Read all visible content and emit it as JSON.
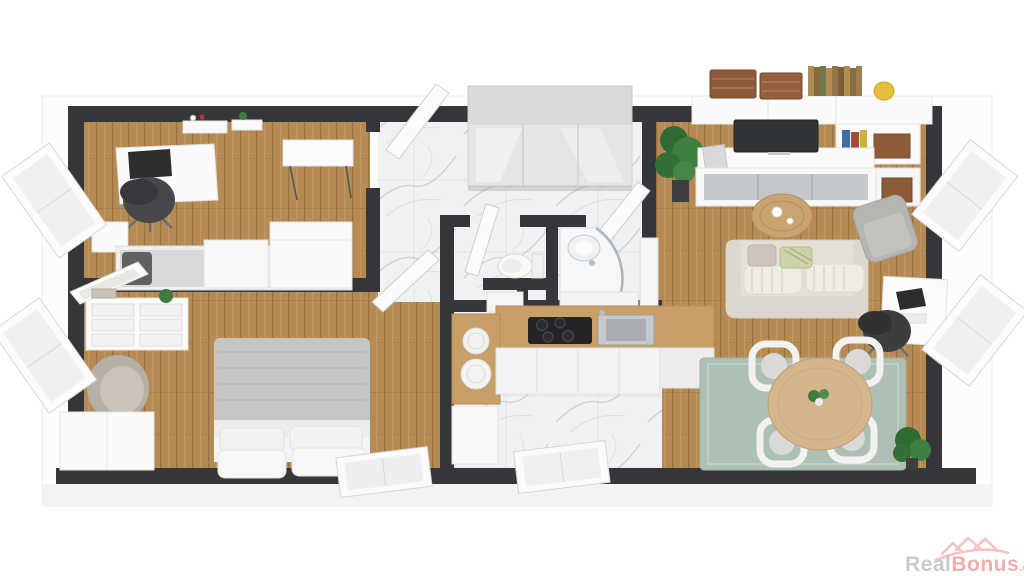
{
  "watermark": {
    "text_real": "Real",
    "text_bonus": "Bonus",
    "text_tld": ".cz",
    "color_real": "#c9c9c9",
    "color_bonus": "#f0aeae",
    "logo": "houses-roofline-swoosh"
  },
  "palette": {
    "background": "#ffffff",
    "outer_slab": "#fcfcfd",
    "wall_dark": "#34363a",
    "wall_white": "#f6f6f6",
    "wood_floor": "#b58b53",
    "wood_counter": "#c89f67",
    "marble_floor": "#f0f1f2",
    "rug_sage": "#aebfb6",
    "sofa_beige": "#e4e0d9",
    "armchair_gray": "#b7b5b2",
    "office_chair_dark": "#3b3d3f",
    "tv_dark": "#313437",
    "basket_brown": "#8e5b39",
    "vase_yellow": "#e5bf3c",
    "dining_table_wood": "#d5b68c",
    "plant_green": "#39763b",
    "duvet_gray": "#c5c6c4",
    "closet_gray": "#dfe1e3"
  },
  "scene": {
    "type": "3d-floor-plan-render",
    "view": "isometric-top-down",
    "rooms": [
      {
        "name": "home-office",
        "floor": "wood",
        "furniture": [
          "desk",
          "monitor",
          "office-chair",
          "wall-shelves",
          "tea-table",
          "wall-sideboard",
          "single-bed",
          "dark-pillow",
          "storage-box",
          "storage-chest",
          "nightstand",
          "left-window"
        ]
      },
      {
        "name": "bedroom",
        "floor": "wood",
        "furniture": [
          "double-bed",
          "gray-duvet",
          "four-pillows",
          "dresser",
          "leaning-mirror",
          "books",
          "small-plant",
          "armchair",
          "wardrobe",
          "bottom-window",
          "left-window"
        ]
      },
      {
        "name": "entry-hall",
        "floor": "marble",
        "furniture": [
          "gray-mirrored-wardrobe",
          "open-door-office",
          "open-door-bath"
        ]
      },
      {
        "name": "wc",
        "floor": "marble",
        "furniture": [
          "toilet",
          "open-door-wc",
          "low-cabinet"
        ]
      },
      {
        "name": "bathroom",
        "floor": "marble",
        "furniture": [
          "corner-shower",
          "washbasin",
          "vanity"
        ]
      },
      {
        "name": "kitchen",
        "floor": "marble",
        "furniture": [
          "l-shaped-counter",
          "cooktop",
          "steel-sink",
          "stacked-plates",
          "base-cabinets",
          "low-unit",
          "bottom-window"
        ]
      },
      {
        "name": "living-room",
        "floor": "wood",
        "furniture": [
          "wall-shelving-unit",
          "tv",
          "wicker-baskets",
          "book-rows",
          "yellow-vase",
          "glass-cabinet",
          "coffee-table",
          "sofa",
          "pillows",
          "armchair",
          "computer-desk",
          "laptop",
          "office-chair",
          "dining-table",
          "flower-centerpiece",
          "four-dining-chairs",
          "sage-rug",
          "floor-plant-left",
          "floor-plant-corner",
          "right-windows"
        ]
      }
    ]
  }
}
